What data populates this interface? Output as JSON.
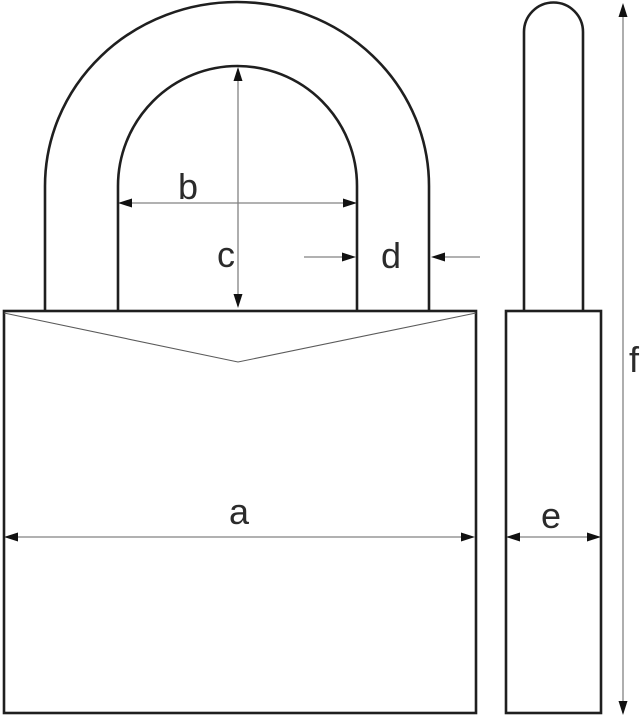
{
  "diagram": {
    "kind": "padlock-dimension-drawing",
    "labels": {
      "a": "a",
      "b": "b",
      "c": "c",
      "d": "d",
      "e": "e",
      "f": "f"
    }
  },
  "colors": {
    "background": "#ffffff",
    "outline": "#1f1f1f",
    "dimension_line": "#828282",
    "arrowhead": "#111111",
    "notch_line": "#5a5a5a",
    "label_text": "#2b2b2b"
  }
}
